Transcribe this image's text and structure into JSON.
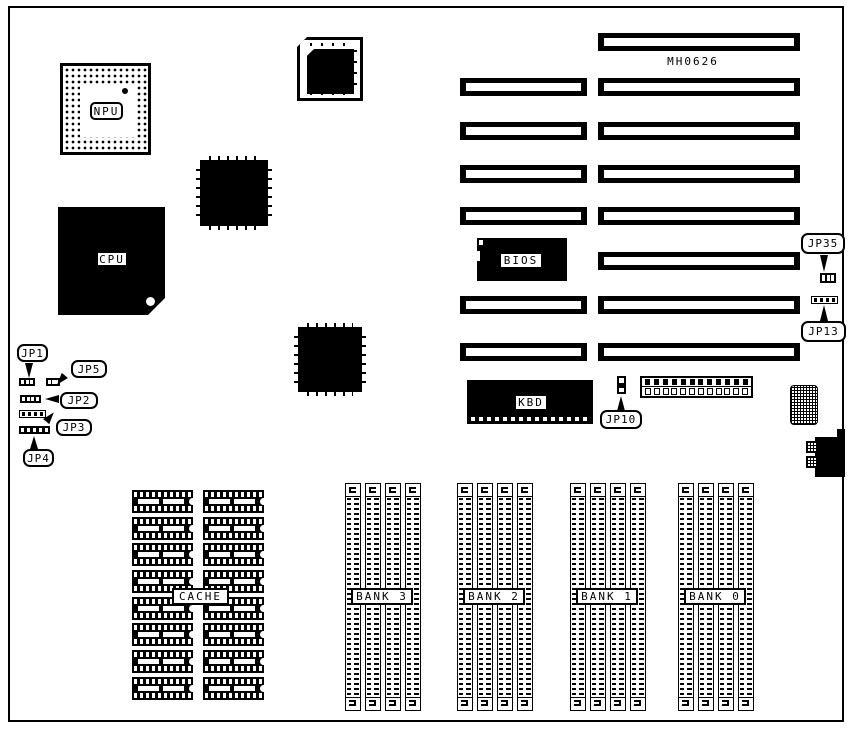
{
  "diagram": {
    "model_number": "MH0626",
    "components": {
      "npu": "NPU",
      "cpu": "CPU",
      "bios": "BIOS",
      "kbd": "KBD",
      "cache": "CACHE"
    },
    "memory_banks": [
      "BANK 3",
      "BANK 2",
      "BANK 1",
      "BANK 0"
    ],
    "jumpers": {
      "jp1": "JP1",
      "jp2": "JP2",
      "jp3": "JP3",
      "jp4": "JP4",
      "jp5": "JP5",
      "jp10": "JP10",
      "jp13": "JP13",
      "jp35": "JP35"
    },
    "colors": {
      "ink": "#000000",
      "paper": "#ffffff"
    },
    "structure": {
      "cache_chip_rows": 8,
      "cache_chip_columns": 2,
      "memory_bank_count": 4,
      "simm_sockets_per_bank": 4,
      "power_connector_pins": 12,
      "isa_slot_rows_long": 8,
      "isa_slot_rows_short": 6
    }
  }
}
